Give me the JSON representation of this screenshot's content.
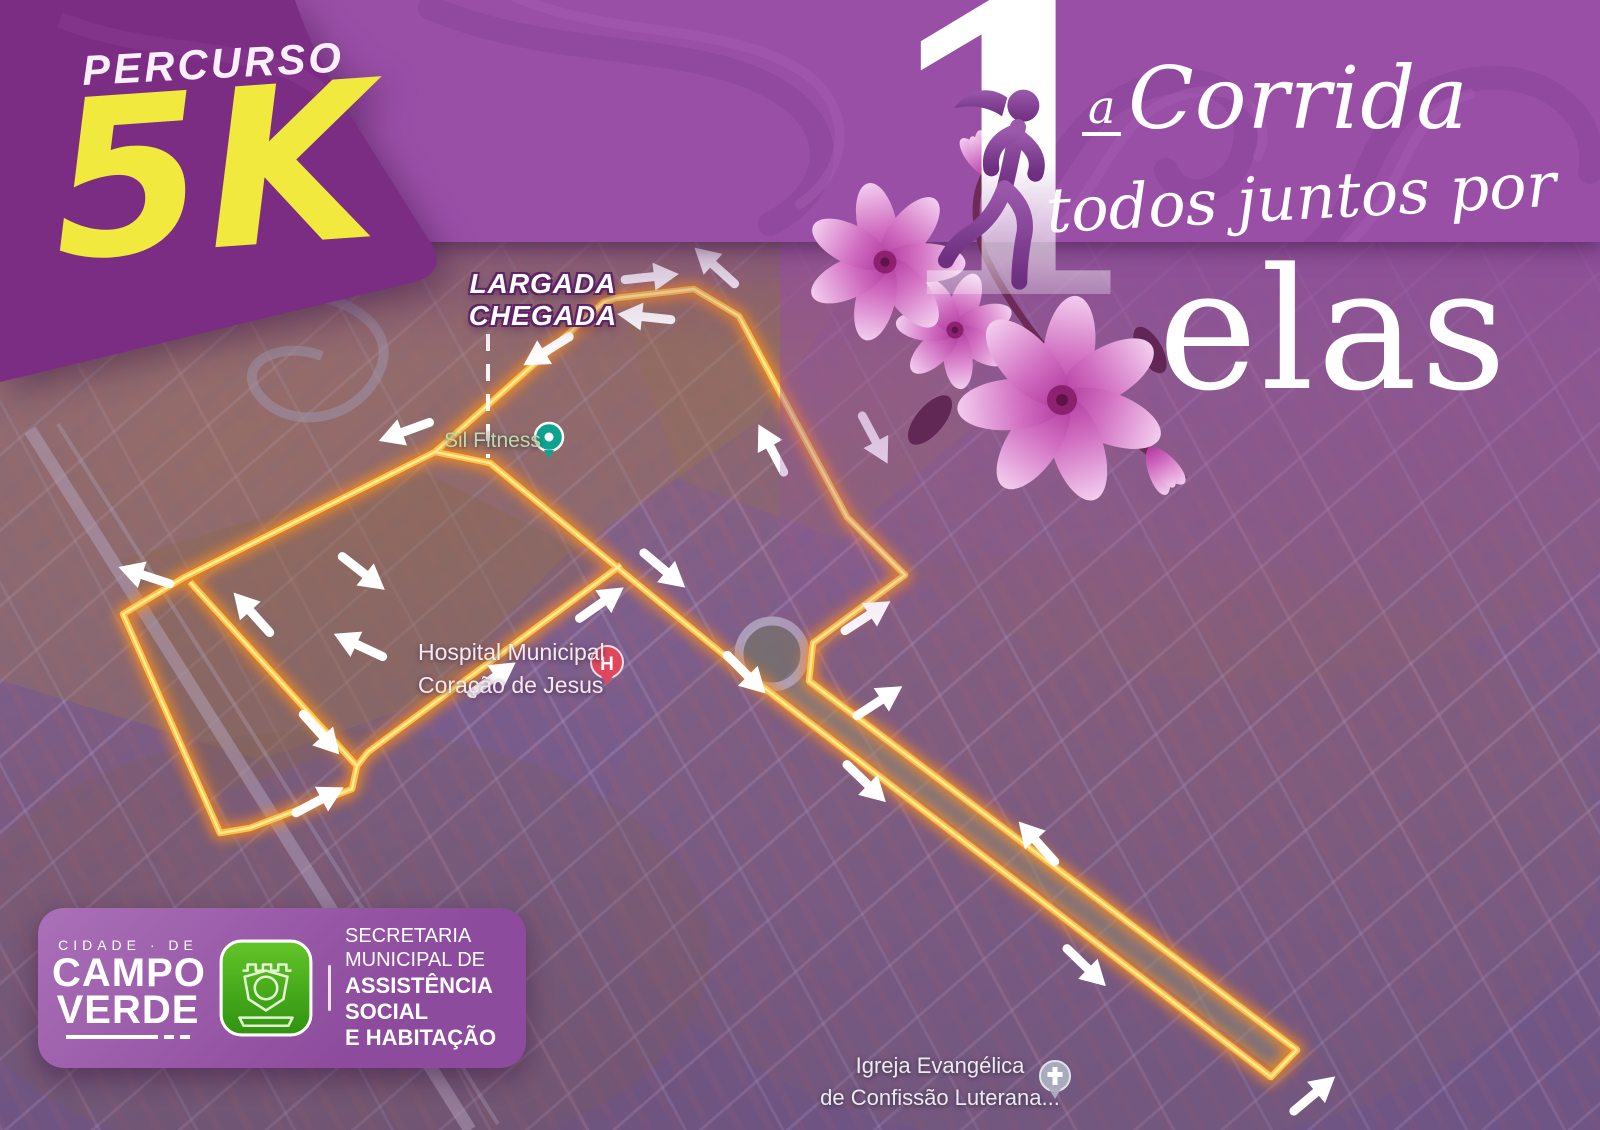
{
  "route_badge": {
    "kicker": "PERCURSO",
    "distance": "5K"
  },
  "event": {
    "edition_number": "1",
    "edition_ordinal": "a",
    "title_word": "Corrida",
    "subtitle": "todos juntos por",
    "highlight": "elas"
  },
  "map": {
    "start_finish": {
      "line1": "LARGADA",
      "line2": "CHEGADA"
    },
    "pois": {
      "gym": {
        "label": "Sil Fitness"
      },
      "hospital": {
        "line1": "Hospital Municipal",
        "line2": "Coração de Jesus",
        "marker_letter": "H"
      },
      "church": {
        "line1": "Igreja Evangélica",
        "line2": "de Confissão Luterana..."
      }
    }
  },
  "footer": {
    "city": {
      "kicker": "CIDADE · DE",
      "name_line1": "CAMPO",
      "name_line2": "VERDE"
    },
    "department": {
      "line1": "SECRETARIA",
      "line2": "MUNICIPAL DE",
      "line3": "ASSISTÊNCIA SOCIAL",
      "line4": "E HABITAÇÃO"
    }
  },
  "colors": {
    "band_purple": "#9a4fa7",
    "badge_purple": "#7b2c83",
    "accent_yellow": "#f2e93e",
    "route_core_yellow": "#ffc43e",
    "route_glow_orange": "#ff8d1e",
    "hospital_red": "#e0475c",
    "gym_teal": "#0fa38f",
    "flower_pink": "#d06cc0",
    "logo_green": "#46a81c"
  }
}
